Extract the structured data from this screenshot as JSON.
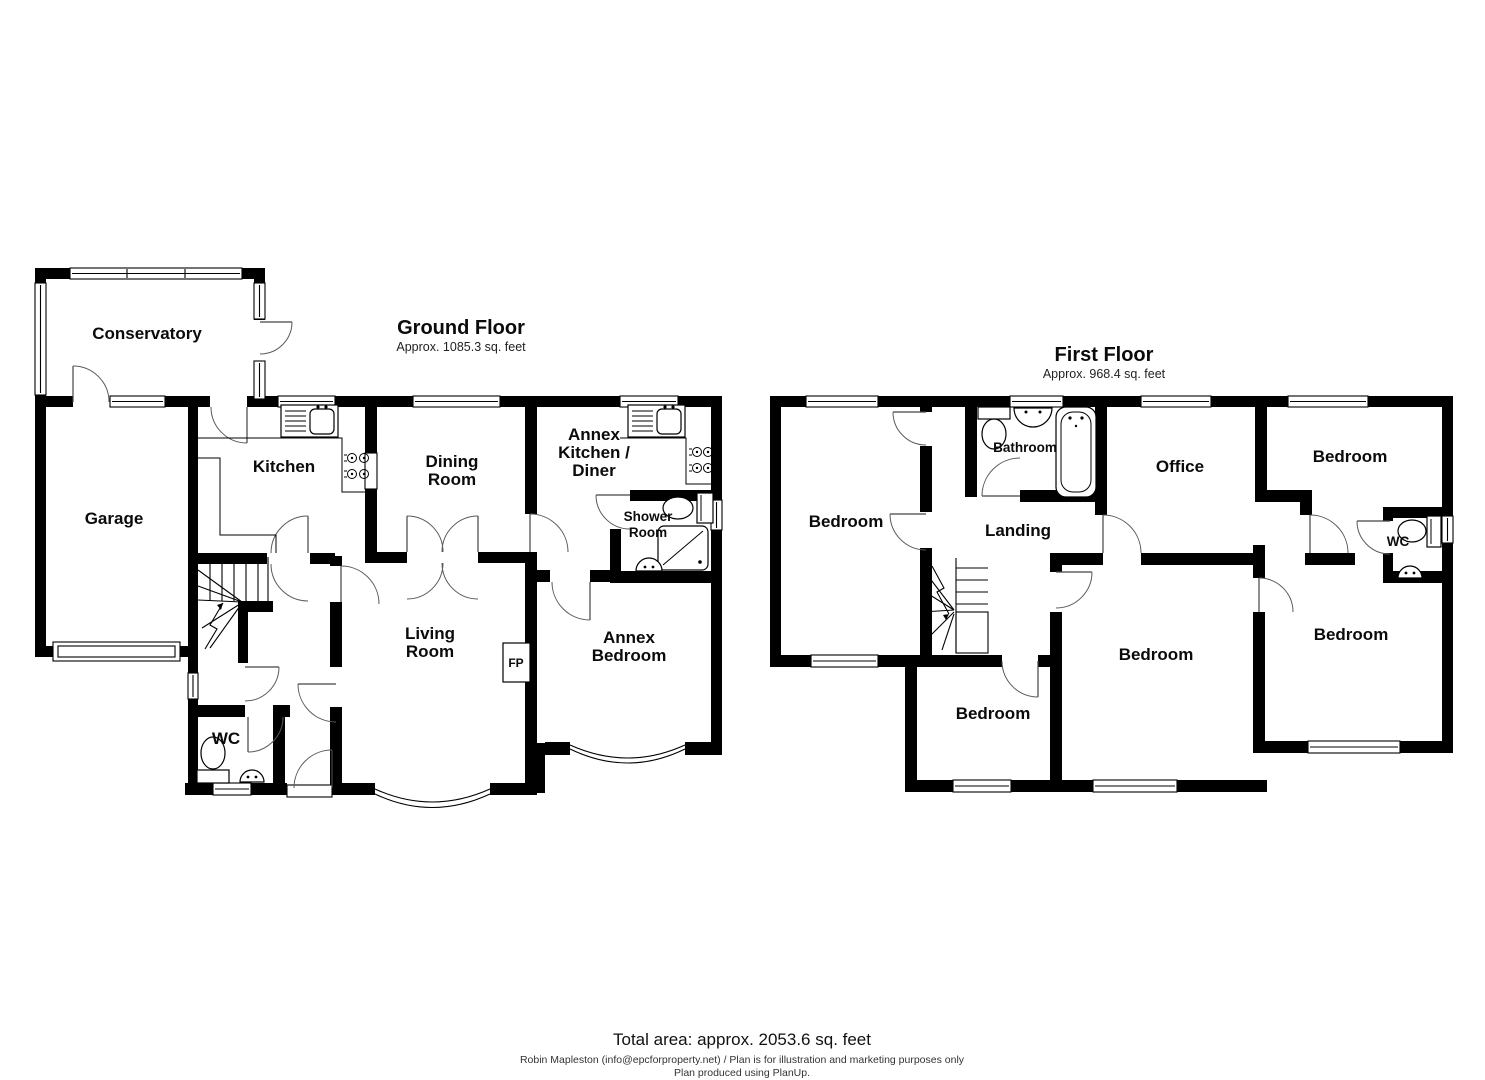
{
  "page": {
    "background": "#ffffff",
    "wall_color": "#000000"
  },
  "ground_floor": {
    "title": "Ground Floor",
    "subtitle": "Approx. 1085.3 sq. feet",
    "labels": {
      "conservatory": [
        "Conservatory"
      ],
      "garage": [
        "Garage"
      ],
      "kitchen": [
        "Kitchen"
      ],
      "dining_room": [
        "Dining",
        "Room"
      ],
      "annex_kitchen_diner": [
        "Annex",
        "Kitchen /",
        "Diner"
      ],
      "shower_room": [
        "Shower",
        "Room"
      ],
      "living_room": [
        "Living",
        "Room"
      ],
      "annex_bedroom": [
        "Annex",
        "Bedroom"
      ],
      "wc": [
        "WC"
      ],
      "fireplace": [
        "FP"
      ]
    }
  },
  "first_floor": {
    "title": "First Floor",
    "subtitle": "Approx. 968.4 sq. feet",
    "labels": {
      "bedroom_top_left": [
        "Bedroom"
      ],
      "bathroom": [
        "Bathroom"
      ],
      "office": [
        "Office"
      ],
      "bedroom_top_right": [
        "Bedroom"
      ],
      "landing": [
        "Landing"
      ],
      "wc": [
        "WC"
      ],
      "bedroom_right": [
        "Bedroom"
      ],
      "bedroom_center": [
        "Bedroom"
      ],
      "bedroom_bottom_left": [
        "Bedroom"
      ]
    }
  },
  "footer": {
    "total_area": "Total area: approx. 2053.6 sq. feet",
    "credit": "Robin Mapleston (info@epcforproperty.net) / Plan is for illustration and marketing purposes only",
    "produced": "Plan produced using PlanUp."
  }
}
